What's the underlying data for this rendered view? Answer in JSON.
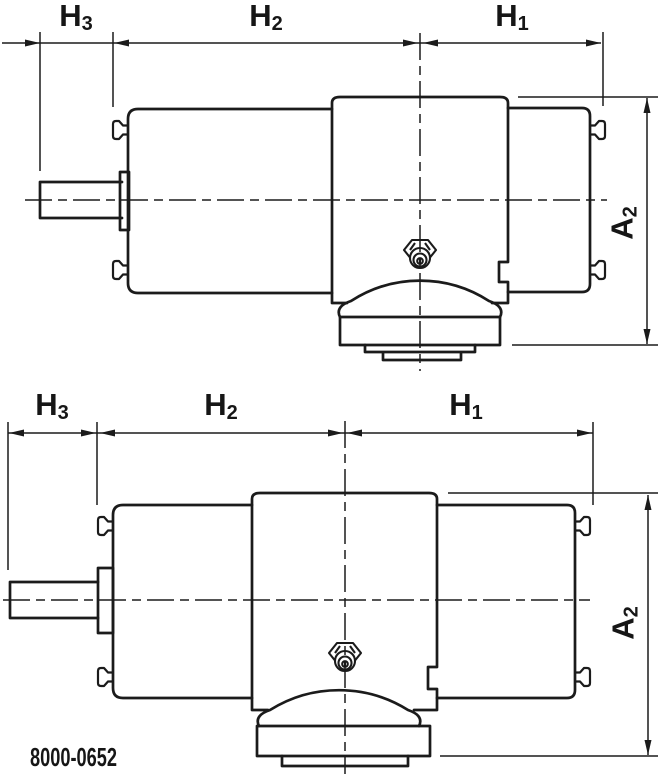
{
  "figure": {
    "code": "8000-0652",
    "line_color": "#1b1b1b",
    "background_color": "#ffffff",
    "dimension_labels": {
      "h3": {
        "base": "H",
        "sub": "3"
      },
      "h2": {
        "base": "H",
        "sub": "2"
      },
      "h1": {
        "base": "H",
        "sub": "1"
      },
      "a2": {
        "base": "A",
        "sub": "2"
      }
    },
    "views": [
      {
        "id": "top-view",
        "dimensions_shown": [
          "H3",
          "H2",
          "H1",
          "A2"
        ]
      },
      {
        "id": "bottom-view",
        "dimensions_shown": [
          "H3",
          "H2",
          "H1",
          "A2"
        ]
      }
    ]
  }
}
